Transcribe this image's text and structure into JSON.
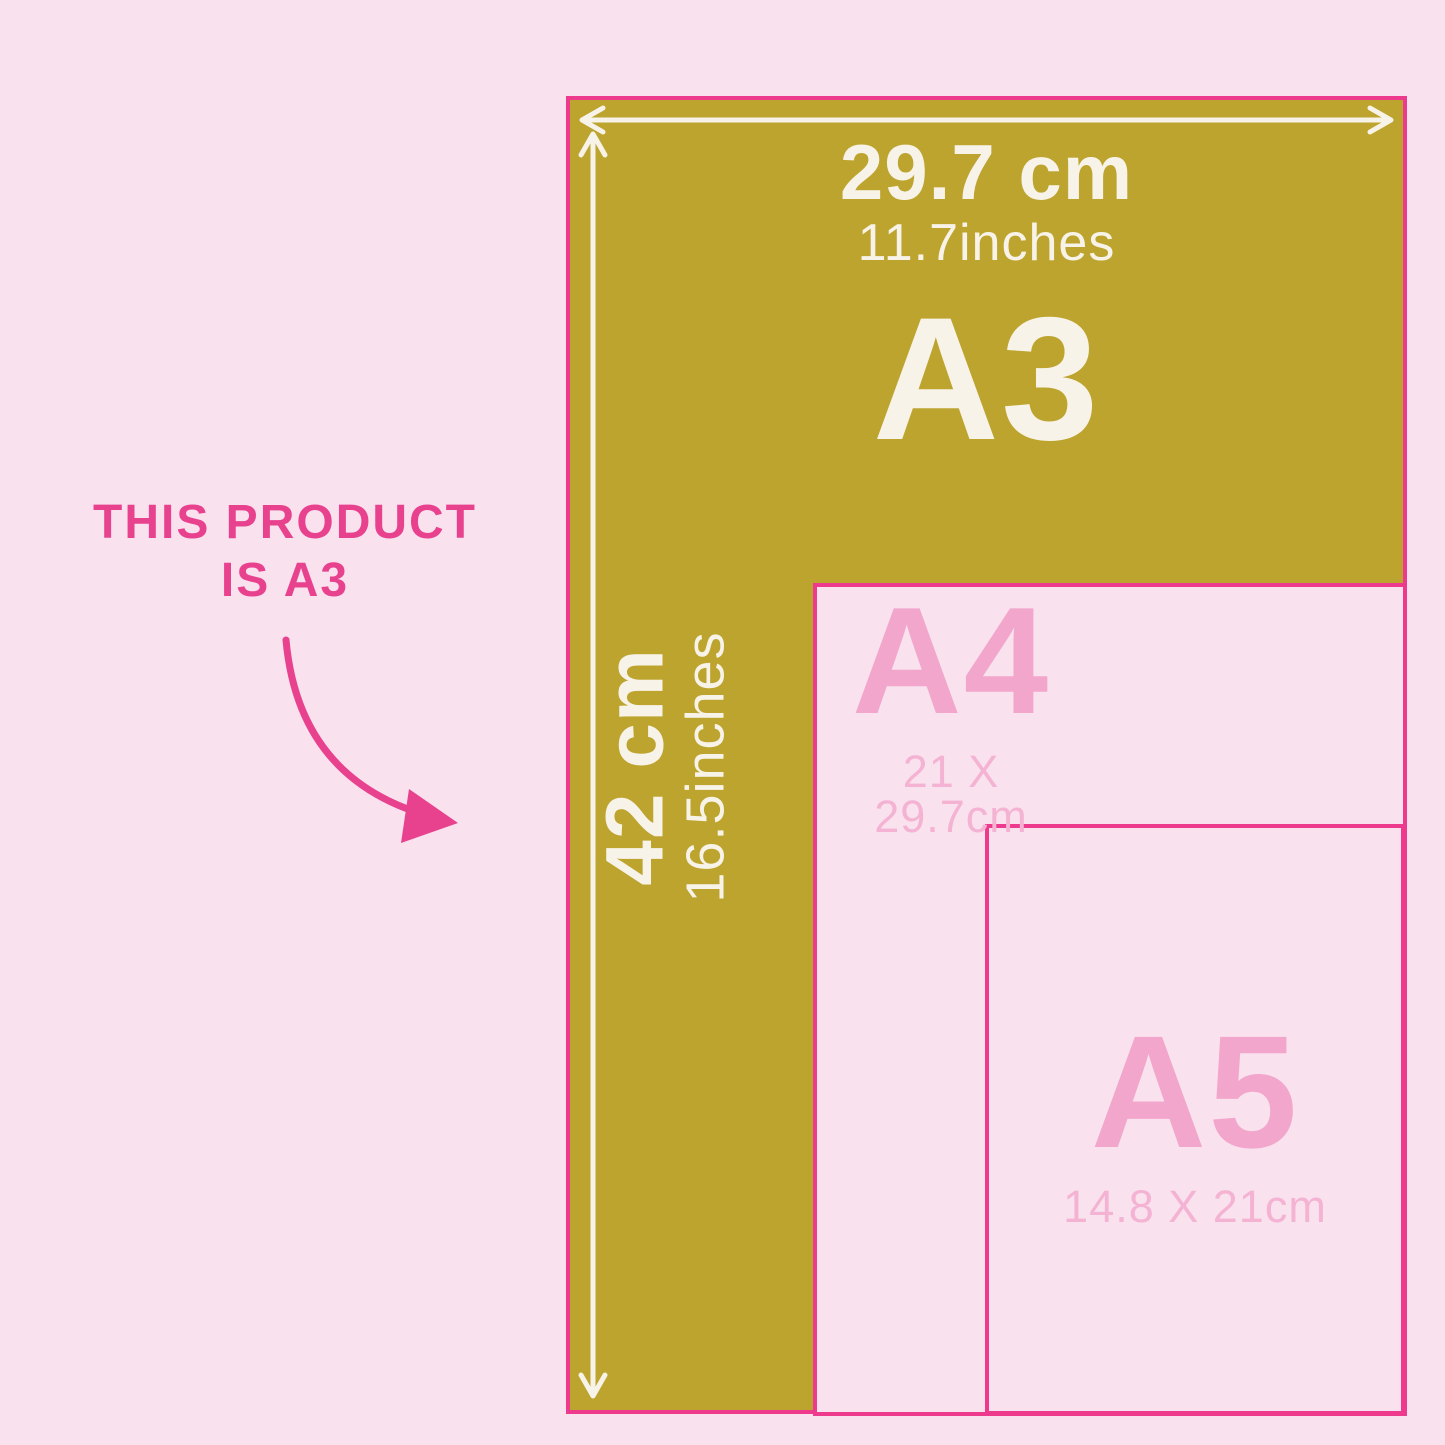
{
  "colors": {
    "bg": "#f9e1ee",
    "olive": "#bda42e",
    "paper": "#f9e1ee",
    "border": "#ee3a8d",
    "hot": "#e8428f",
    "label": "#f2a6cb",
    "size": "#f4b3d3",
    "cream": "#f8f3e8"
  },
  "note": {
    "line1": "THIS PRODUCT",
    "line2": "IS A3"
  },
  "a3": {
    "label": "A3",
    "width_cm": "29.7 cm",
    "width_inches": "11.7inches",
    "height_cm": "42 cm",
    "height_inches": "16.5inches"
  },
  "a4": {
    "label": "A4",
    "dimensions": "21 X 29.7cm"
  },
  "a5": {
    "label": "A5",
    "dimensions": "14.8 X 21cm"
  }
}
